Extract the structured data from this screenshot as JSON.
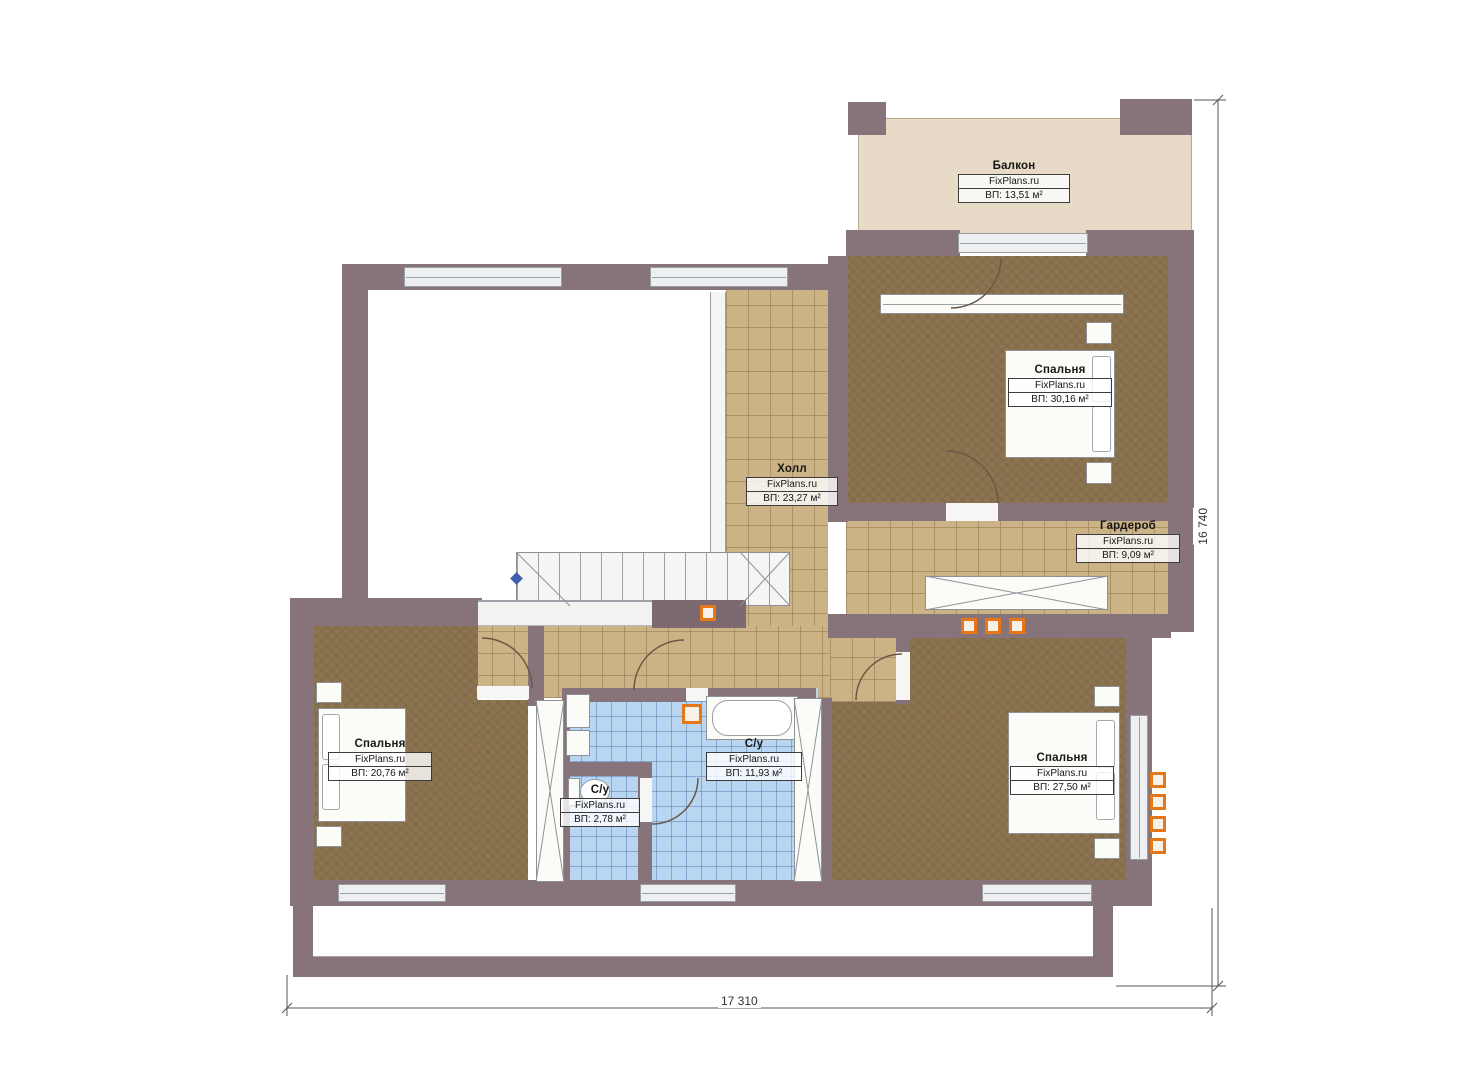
{
  "plan": {
    "brand": "FixPlans.ru",
    "rooms": [
      {
        "id": "balcony",
        "name": "Балкон",
        "brand": "FixPlans.ru",
        "area": "ВП: 13,51 м²"
      },
      {
        "id": "bedroom-top",
        "name": "Спальня",
        "brand": "FixPlans.ru",
        "area": "ВП: 30,16 м²"
      },
      {
        "id": "hall",
        "name": "Холл",
        "brand": "FixPlans.ru",
        "area": "ВП: 23,27 м²"
      },
      {
        "id": "wardrobe",
        "name": "Гардероб",
        "brand": "FixPlans.ru",
        "area": "ВП: 9,09 м²"
      },
      {
        "id": "bedroom-left",
        "name": "Спальня",
        "brand": "FixPlans.ru",
        "area": "ВП: 20,76 м²"
      },
      {
        "id": "bath-small",
        "name": "С/у",
        "brand": "FixPlans.ru",
        "area": "ВП: 2,78 м²"
      },
      {
        "id": "bath-large",
        "name": "С/у",
        "brand": "FixPlans.ru",
        "area": "ВП: 11,93 м²"
      },
      {
        "id": "bedroom-right",
        "name": "Спальня",
        "brand": "FixPlans.ru",
        "area": "ВП: 27,50 м²"
      }
    ],
    "dimensions": {
      "width_label": "17 310",
      "height_label": "16 740"
    },
    "colors": {
      "wall": "#87747b",
      "carpet": "#8c7450",
      "tile": "#ccb385",
      "bath_tile": "#b8d5f2",
      "balcony": "#e7dbc8",
      "accent_orange": "#e67817"
    }
  }
}
